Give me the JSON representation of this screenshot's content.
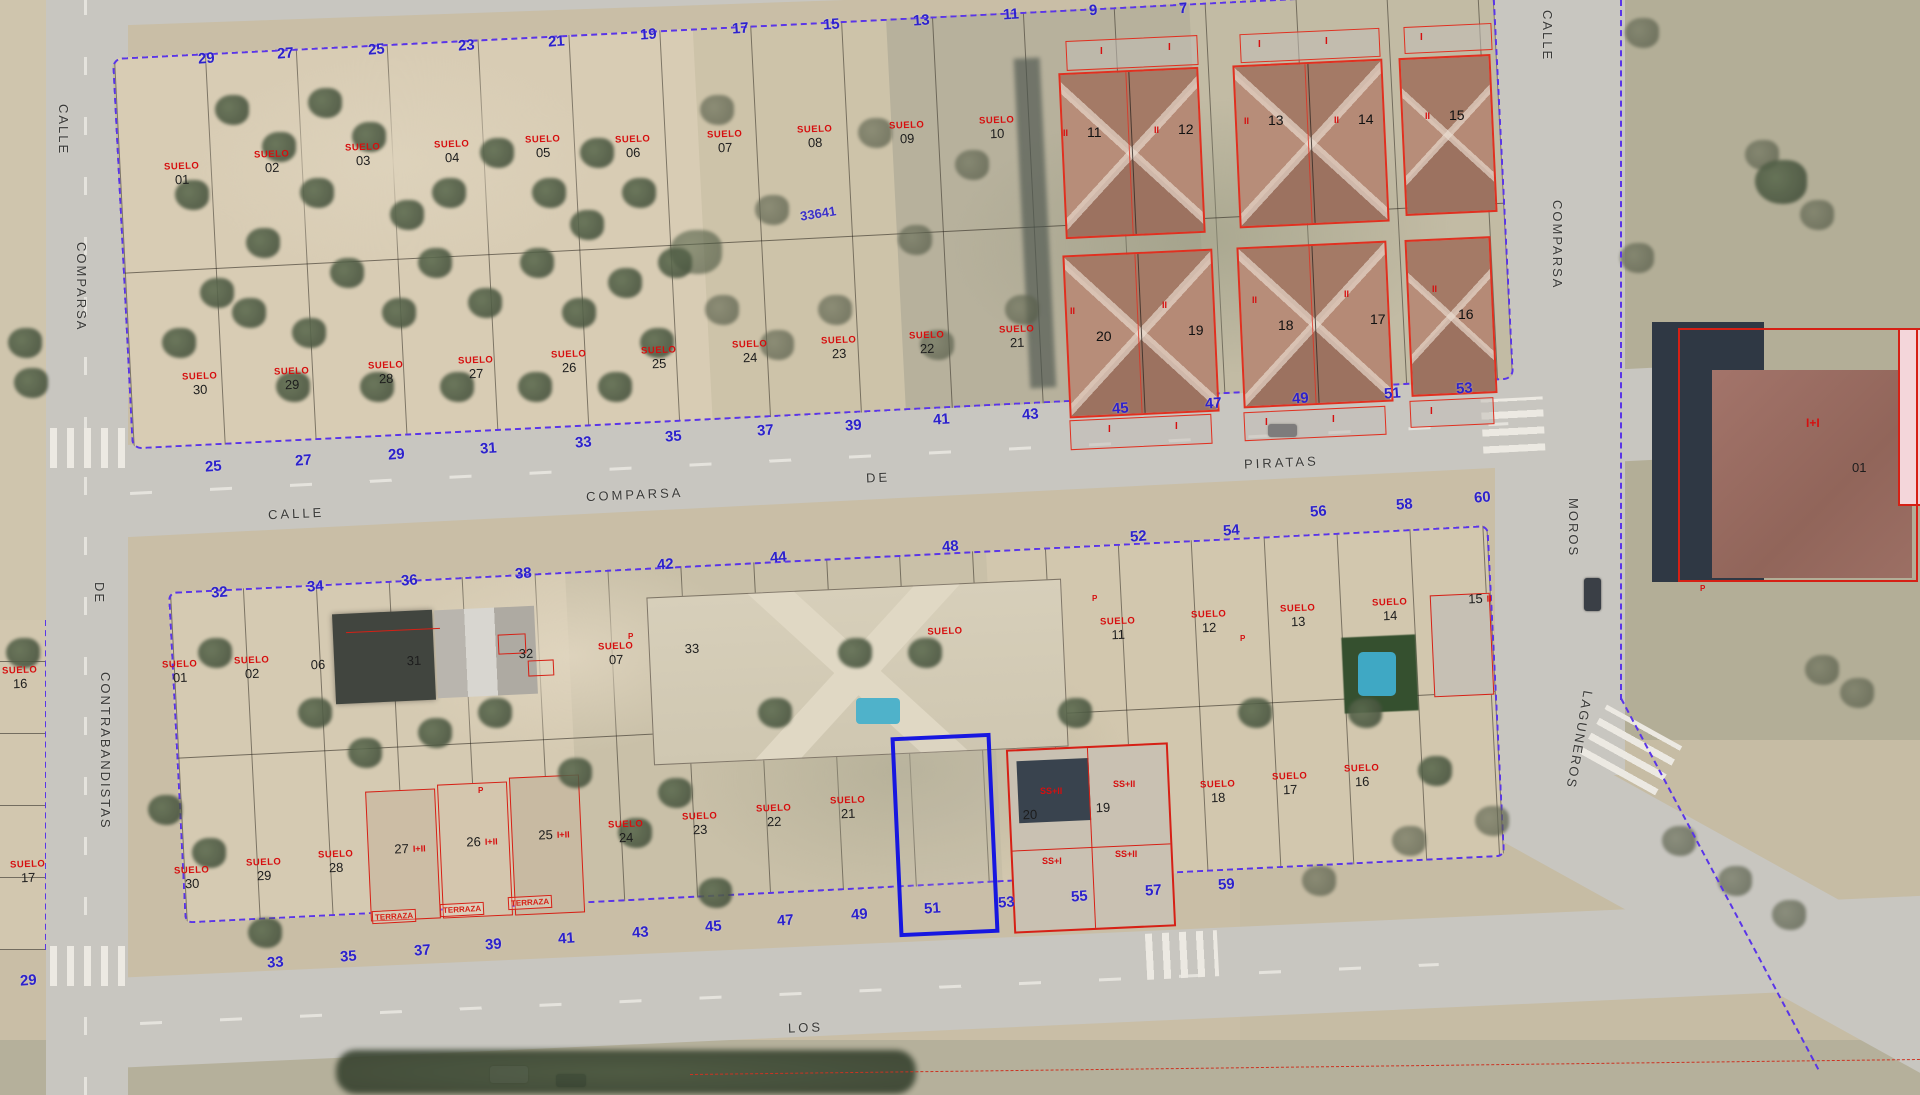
{
  "streets": {
    "left_vertical": [
      "CALLE",
      "COMPARSA",
      "DE",
      "CONTRABANDISTAS"
    ],
    "main_road": [
      "CALLE",
      "COMPARSA",
      "DE",
      "PIRATAS"
    ],
    "right_vertical": [
      "CALLE",
      "COMPARSA",
      "MOROS",
      "LAGUNEROS"
    ],
    "bottom_road": "LOS"
  },
  "block1": {
    "north_numbers": [
      "29",
      "27",
      "25",
      "23",
      "21",
      "19",
      "17",
      "15",
      "13",
      "11",
      "9",
      "7"
    ],
    "south_numbers": [
      "25",
      "27",
      "29",
      "31",
      "33",
      "35",
      "37",
      "39",
      "41",
      "43",
      "45",
      "47",
      "49",
      "51",
      "53"
    ],
    "row1_parcels": [
      {
        "tag": "SUELO",
        "num": "01"
      },
      {
        "tag": "SUELO",
        "num": "02"
      },
      {
        "tag": "SUELO",
        "num": "03"
      },
      {
        "tag": "SUELO",
        "num": "04"
      },
      {
        "tag": "SUELO",
        "num": "05"
      },
      {
        "tag": "SUELO",
        "num": "06"
      },
      {
        "tag": "SUELO",
        "num": "07"
      },
      {
        "tag": "SUELO",
        "num": "08"
      },
      {
        "tag": "SUELO",
        "num": "09"
      },
      {
        "tag": "SUELO",
        "num": "10"
      }
    ],
    "row2_parcels": [
      {
        "tag": "SUELO",
        "num": "30"
      },
      {
        "tag": "SUELO",
        "num": "29"
      },
      {
        "tag": "SUELO",
        "num": "28"
      },
      {
        "tag": "SUELO",
        "num": "27"
      },
      {
        "tag": "SUELO",
        "num": "26"
      },
      {
        "tag": "SUELO",
        "num": "25"
      },
      {
        "tag": "SUELO",
        "num": "24"
      },
      {
        "tag": "SUELO",
        "num": "23"
      },
      {
        "tag": "SUELO",
        "num": "22"
      },
      {
        "tag": "SUELO",
        "num": "21"
      }
    ],
    "house_numbers_row1": [
      "11",
      "12",
      "13",
      "14",
      "15"
    ],
    "house_numbers_row2": [
      "20",
      "19",
      "18",
      "17",
      "16"
    ],
    "floor_label": "II",
    "porch_label": "I",
    "ref_code": "33641"
  },
  "block2": {
    "north_numbers": [
      "32",
      "34",
      "36",
      "38",
      "42",
      "44",
      "48",
      "52",
      "54",
      "56",
      "58",
      "60"
    ],
    "south_numbers": [
      "33",
      "35",
      "37",
      "39",
      "41",
      "43",
      "45",
      "47",
      "49",
      "51",
      "53",
      "55",
      "57",
      "59"
    ],
    "row1_labels": [
      {
        "tag": "SUELO",
        "num": "01"
      },
      {
        "tag": "SUELO",
        "num": "02"
      },
      {
        "num": "06"
      },
      {
        "num": "31"
      },
      {
        "num": "32"
      },
      {
        "tag": "SUELO",
        "num": "07"
      },
      {
        "num": "33"
      },
      {
        "tag": "SUELO"
      },
      {
        "tag": "SUELO",
        "num": "11"
      },
      {
        "tag": "SUELO",
        "num": "12"
      },
      {
        "tag": "SUELO",
        "num": "13"
      },
      {
        "tag": "SUELO",
        "num": "14"
      },
      {
        "num": "15",
        "floor": "II"
      }
    ],
    "row2_labels": [
      {
        "tag": "SUELO",
        "num": "30"
      },
      {
        "tag": "SUELO",
        "num": "29"
      },
      {
        "tag": "SUELO",
        "num": "28"
      },
      {
        "num": "27",
        "floor": "I+II"
      },
      {
        "num": "26",
        "floor": "I+II"
      },
      {
        "num": "25",
        "floor": "I+II"
      },
      {
        "tag": "SUELO",
        "num": "24"
      },
      {
        "tag": "SUELO",
        "num": "23"
      },
      {
        "tag": "SUELO",
        "num": "22"
      },
      {
        "tag": "SUELO",
        "num": "21"
      },
      {
        "num": "20"
      },
      {
        "num": "19"
      },
      {
        "tag": "SUELO",
        "num": "18"
      },
      {
        "tag": "SUELO",
        "num": "17"
      },
      {
        "tag": "SUELO",
        "num": "16"
      }
    ],
    "ss_labels": [
      "SS+II",
      "SS+II",
      "SS+I",
      "SS+II"
    ],
    "terrace_label": "TERRAZA"
  },
  "right_area": {
    "building_floor_label": "I+I",
    "building_num": "01"
  },
  "left_parcels": [
    {
      "tag": "SUELO",
      "num": "16"
    },
    {
      "tag": "SUELO",
      "num": "17"
    }
  ],
  "corner_number": "29",
  "p_marker": "P"
}
